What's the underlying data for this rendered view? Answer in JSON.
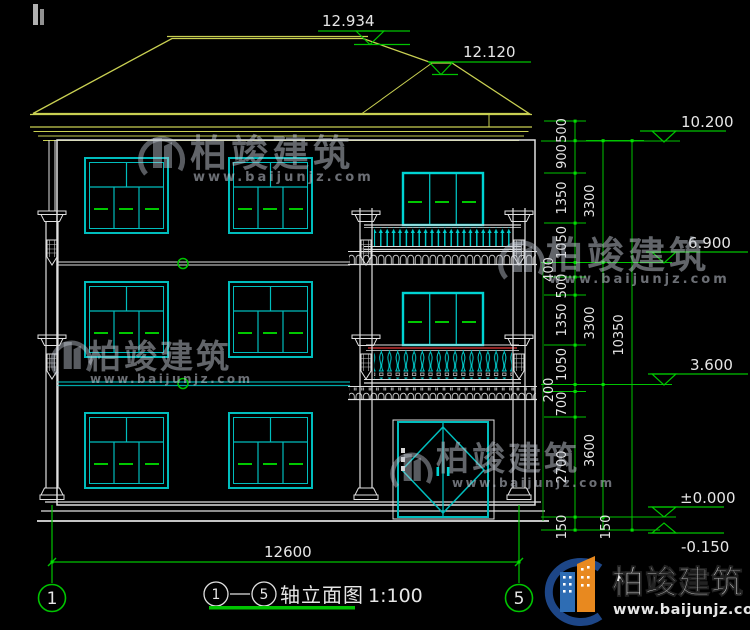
{
  "annotations": {
    "ridge_main": "12.934",
    "ridge_wing": "12.120",
    "levels": {
      "eave": "10.200",
      "third": "6.900",
      "second": "3.600",
      "ground": "±0.000",
      "base": "-0.150"
    },
    "segments_col1": [
      "500",
      "900",
      "1350",
      "1050",
      "400",
      "500",
      "1350",
      "1050",
      "200",
      "700",
      "2700",
      "150"
    ],
    "spans_col2": [
      "3300",
      "3300",
      "3600",
      "150"
    ],
    "total_col3": "10350",
    "width_total": "12600",
    "axis_left": "1",
    "axis_right": "5"
  },
  "title": {
    "axis_start": "1",
    "axis_end": "5",
    "text": "轴立面图",
    "scale": "1:100"
  },
  "watermark": {
    "brand": "柏竣建筑",
    "url": "www.baijunjz.com"
  },
  "footer": {
    "brand": "柏竣建筑",
    "url": "www.baijunjz.com"
  },
  "colors": {
    "background": "#000000",
    "line_white": "#e6e6e6",
    "cad_cyan": "#00bdbd",
    "roof_yellow": "#c9d052",
    "dim_green": "#00c400",
    "rail_red": "#c03030"
  }
}
